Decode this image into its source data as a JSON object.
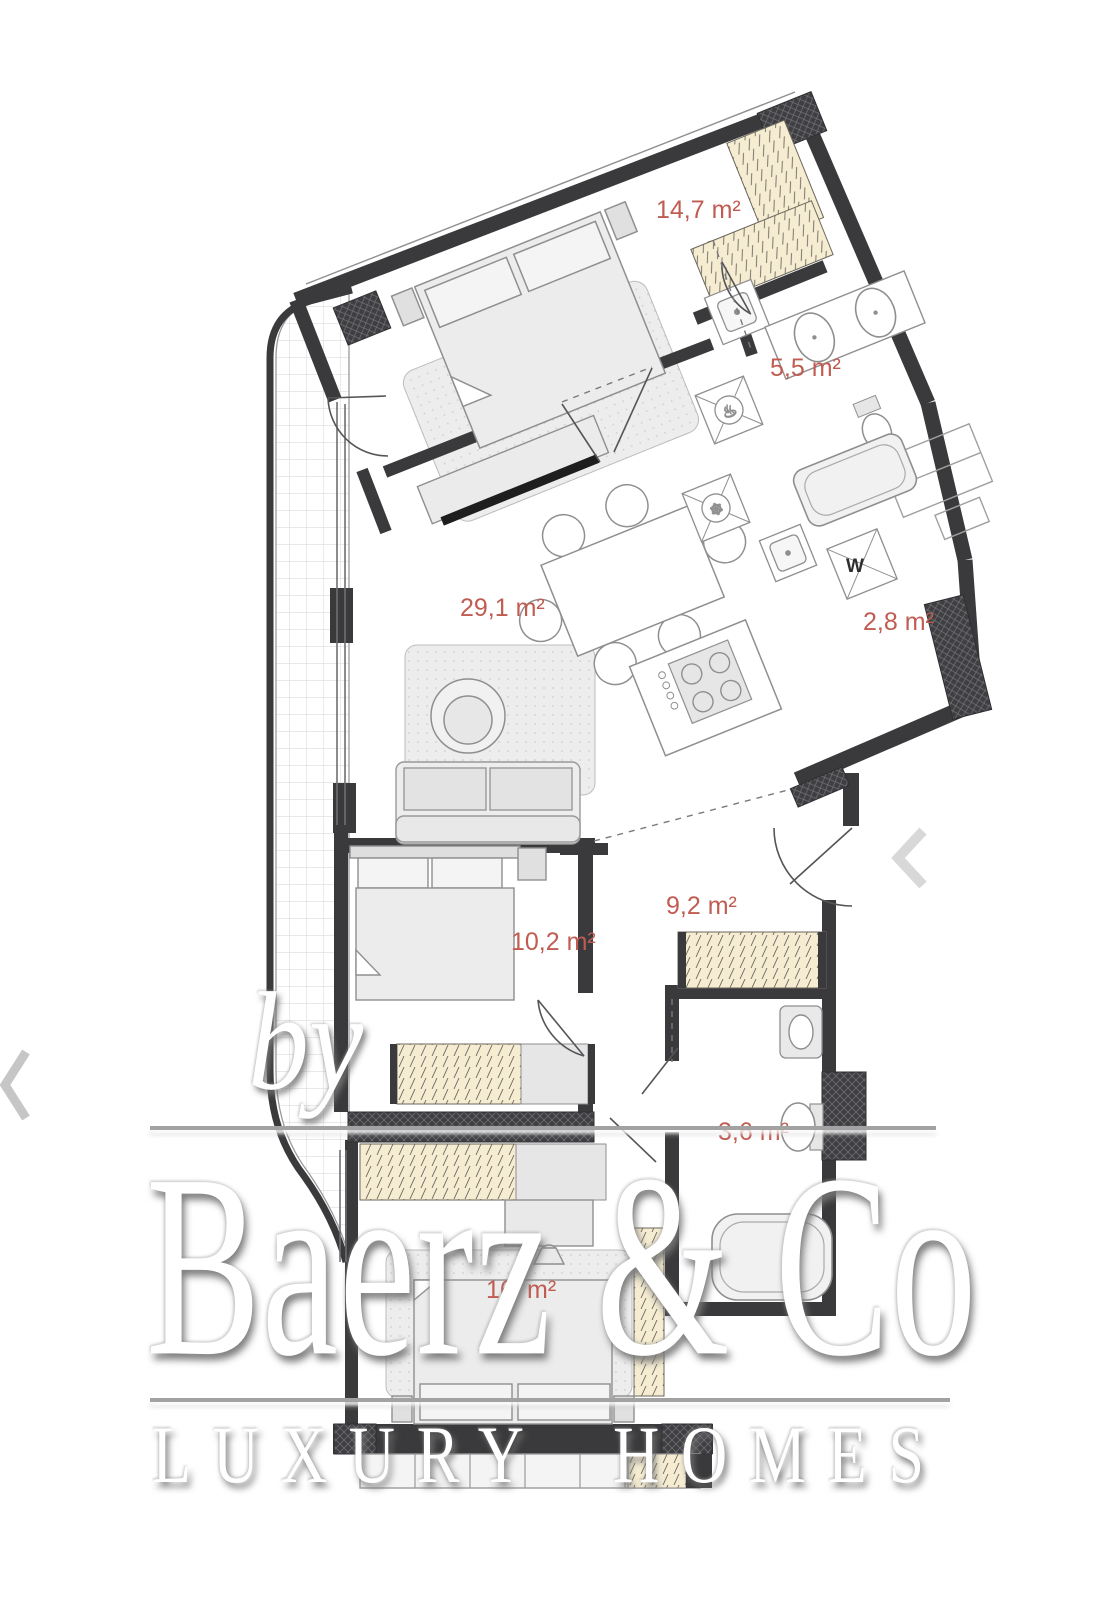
{
  "floor_plan": {
    "rooms": [
      {
        "name": "bedroom-top",
        "area_label": "14,7 m²"
      },
      {
        "name": "bathroom-top",
        "area_label": "5,5 m²"
      },
      {
        "name": "living-kitchen",
        "area_label": "29,1 m²"
      },
      {
        "name": "laundry",
        "area_label": "2,8 m²"
      },
      {
        "name": "hallway",
        "area_label": "9,2 m²"
      },
      {
        "name": "bedroom-middle",
        "area_label": "10,2 m²"
      },
      {
        "name": "bathroom-bottom",
        "area_label": "3,6 m²"
      },
      {
        "name": "bedroom-bottom",
        "area_label_left": "16",
        "area_label_right": "m²"
      }
    ],
    "appliance_labels": {
      "washer": "W"
    },
    "colors": {
      "wall": "#3a3a3c",
      "area_label": "#c05c52",
      "wardrobe_fill": "#f5ecd2",
      "furniture_fill": "#ececec",
      "furniture_stroke": "#8f8f8f",
      "balcony_tile_line": "#dcdcdc"
    }
  },
  "watermark": {
    "prefix": "by",
    "brand": "Baerz & Co",
    "tagline": "LUXURY HOMES"
  },
  "carousel": {
    "prev_symbol": "‹",
    "next_symbol": "‹"
  }
}
